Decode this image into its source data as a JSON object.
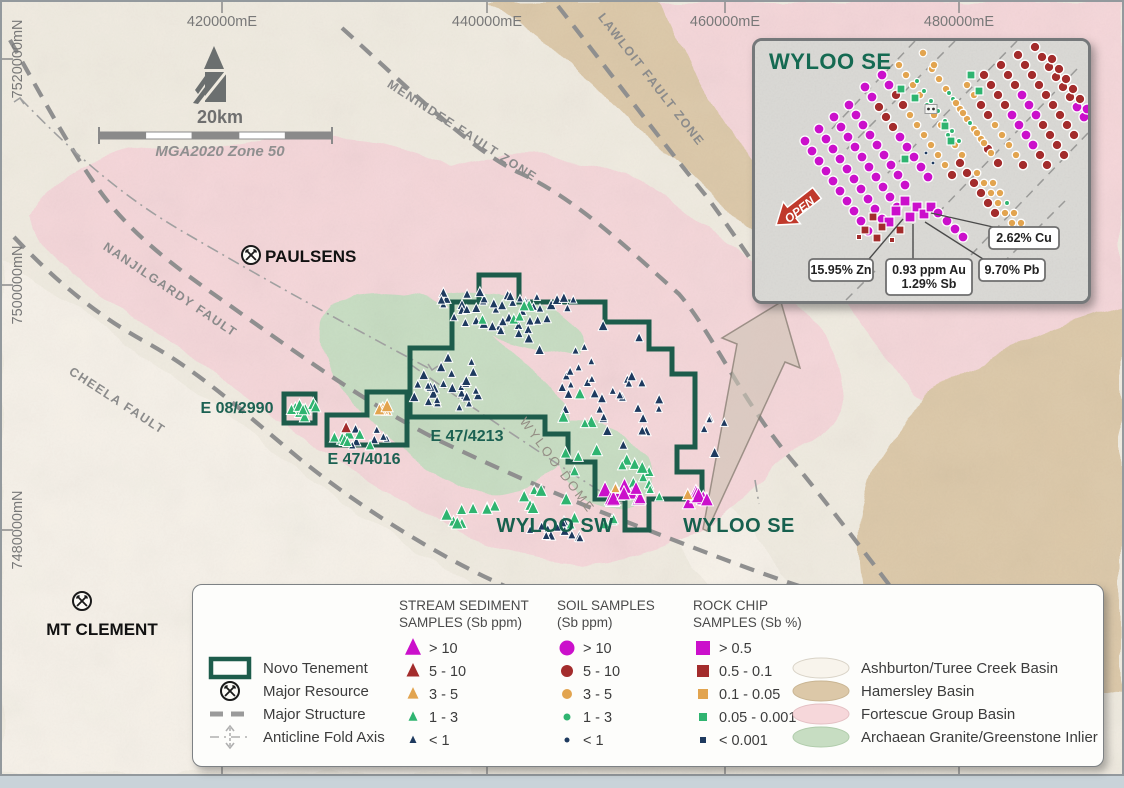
{
  "colors": {
    "magenta": "#cb10cb",
    "dark_red": "#a32c2c",
    "orange": "#e2a44f",
    "green": "#2fb470",
    "navy": "#1e3a5f",
    "tenement": "#1d5c4b",
    "label_green": "#156a52",
    "pink": "#f5d6d9",
    "tan": "#dcc8a8",
    "inlier_green": "#c7ddc2",
    "cream": "#f0ebe0",
    "offwhite": "#f7f3ea",
    "fault_gray": "#8f8f8f",
    "coord_gray": "#787878",
    "arrow_red": "#c0392b"
  },
  "map": {
    "eastings": [
      {
        "label": "420000mE",
        "x": 220
      },
      {
        "label": "440000mE",
        "x": 485
      },
      {
        "label": "460000mE",
        "x": 723
      },
      {
        "label": "480000mE",
        "x": 957
      }
    ],
    "northings": [
      {
        "label": "7520000mN",
        "y": 57
      },
      {
        "label": "7500000mN",
        "y": 283
      },
      {
        "label": "7480000mN",
        "y": 528
      }
    ],
    "scale": {
      "label": "20km",
      "datum": "MGA2020 Zone 50"
    },
    "places": [
      {
        "name": "PAULSENS",
        "sx": 249,
        "sy": 253,
        "tx": 263,
        "ty": 260,
        "anchor": "start"
      },
      {
        "name": "MT CLEMENT",
        "sx": 80,
        "sy": 599,
        "tx": 100,
        "ty": 633,
        "anchor": "middle"
      }
    ],
    "fault_labels": [
      {
        "name": "MENINDEE FAULT ZONE",
        "x": 458,
        "y": 132,
        "angle": 33
      },
      {
        "name": "LAWLOIT FAULT ZONE",
        "x": 646,
        "y": 80,
        "angle": 52
      },
      {
        "name": "NANJILGARDY FAULT",
        "x": 166,
        "y": 291,
        "angle": 34
      },
      {
        "name": "CHEELA FAULT",
        "x": 113,
        "y": 402,
        "angle": 33
      }
    ],
    "dome_label": {
      "name": "WYLOO DOME",
      "x": 552,
      "y": 466,
      "angle": 53
    },
    "area_labels": [
      {
        "name": "WYLOO SW",
        "x": 553,
        "y": 530
      },
      {
        "name": "WYLOO SE",
        "x": 737,
        "y": 530
      }
    ],
    "tenements": [
      {
        "name": "E 08/2990",
        "points": "282,392 313,392 313,421 282,421",
        "lx": 235,
        "ly": 411,
        "anchor": "middle"
      },
      {
        "name": "E 47/4016",
        "points": "325,413 365,413 365,390 405,390 405,443 325,443",
        "lx": 362,
        "ly": 462,
        "anchor": "middle"
      },
      {
        "name": "E 47/4213",
        "points": "408,346 450,346 450,300 477,300 477,273 517,273 517,300 603,300 603,320 647,320 647,347 670,347 670,372 693,372 693,445 675,445 675,470 700,470 700,497 647,497 647,528 623,528 623,497 593,497 593,460 566,460 566,432 543,432 543,415 408,415",
        "lx": 465,
        "ly": 439,
        "anchor": "middle"
      }
    ],
    "sample_clusters": [
      {
        "cx": 492,
        "cy": 312,
        "rx": 42,
        "ry": 20,
        "n": 24,
        "c": "navy",
        "s": 7
      },
      {
        "cx": 460,
        "cy": 296,
        "rx": 30,
        "ry": 10,
        "n": 8,
        "c": "navy",
        "s": 7
      },
      {
        "cx": 443,
        "cy": 380,
        "rx": 40,
        "ry": 28,
        "n": 28,
        "c": "navy",
        "s": 7
      },
      {
        "cx": 540,
        "cy": 330,
        "rx": 25,
        "ry": 20,
        "n": 6,
        "c": "navy",
        "s": 7
      },
      {
        "cx": 610,
        "cy": 390,
        "rx": 50,
        "ry": 70,
        "n": 34,
        "c": "navy",
        "s": 7
      },
      {
        "cx": 545,
        "cy": 300,
        "rx": 28,
        "ry": 10,
        "n": 8,
        "c": "navy",
        "s": 7
      },
      {
        "cx": 560,
        "cy": 528,
        "rx": 32,
        "ry": 10,
        "n": 12,
        "c": "navy",
        "s": 7
      },
      {
        "cx": 712,
        "cy": 432,
        "rx": 15,
        "ry": 22,
        "n": 5,
        "c": "navy",
        "s": 7
      },
      {
        "cx": 360,
        "cy": 436,
        "rx": 26,
        "ry": 10,
        "n": 7,
        "c": "navy",
        "s": 7
      },
      {
        "cx": 497,
        "cy": 308,
        "rx": 35,
        "ry": 12,
        "n": 6,
        "c": "green",
        "s": 9
      },
      {
        "cx": 578,
        "cy": 420,
        "rx": 22,
        "ry": 55,
        "n": 8,
        "c": "green",
        "s": 9
      },
      {
        "cx": 470,
        "cy": 512,
        "rx": 30,
        "ry": 12,
        "n": 9,
        "c": "green",
        "s": 9
      },
      {
        "cx": 540,
        "cy": 500,
        "rx": 25,
        "ry": 12,
        "n": 6,
        "c": "green",
        "s": 9
      },
      {
        "cx": 620,
        "cy": 472,
        "rx": 28,
        "ry": 14,
        "n": 7,
        "c": "green",
        "s": 9
      },
      {
        "cx": 302,
        "cy": 407,
        "rx": 13,
        "ry": 9,
        "n": 9,
        "c": "green",
        "s": 9
      },
      {
        "cx": 352,
        "cy": 438,
        "rx": 24,
        "ry": 10,
        "n": 7,
        "c": "green",
        "s": 9
      },
      {
        "cx": 648,
        "cy": 490,
        "rx": 20,
        "ry": 8,
        "n": 5,
        "c": "green",
        "s": 8
      },
      {
        "cx": 590,
        "cy": 520,
        "rx": 25,
        "ry": 8,
        "n": 5,
        "c": "green",
        "s": 8
      },
      {
        "cx": 383,
        "cy": 402,
        "rx": 13,
        "ry": 8,
        "n": 5,
        "c": "orange",
        "s": 10
      },
      {
        "cx": 344,
        "cy": 428,
        "rx": 3,
        "ry": 3,
        "n": 1,
        "c": "dark_red",
        "s": 10
      },
      {
        "cx": 622,
        "cy": 492,
        "rx": 22,
        "ry": 9,
        "n": 11,
        "c": "magenta",
        "s": 12
      },
      {
        "cx": 696,
        "cy": 499,
        "rx": 13,
        "ry": 8,
        "n": 8,
        "c": "magenta",
        "s": 12
      },
      {
        "cx": 617,
        "cy": 487,
        "rx": 4,
        "ry": 3,
        "n": 2,
        "c": "orange",
        "s": 9
      },
      {
        "cx": 686,
        "cy": 492,
        "rx": 3,
        "ry": 3,
        "n": 1,
        "c": "orange",
        "s": 9
      }
    ]
  },
  "inset": {
    "title": "WYLOO SE",
    "open_label": "OPEN",
    "callouts": [
      {
        "lines": [
          "15.95% Zn"
        ],
        "x": 54,
        "y": 218,
        "w": 64,
        "h": 22,
        "tx": 148,
        "ty": 178
      },
      {
        "lines": [
          "0.93 ppm Au",
          "1.29% Sb"
        ],
        "x": 131,
        "y": 218,
        "w": 86,
        "h": 36,
        "tx": 158,
        "ty": 183
      },
      {
        "lines": [
          "9.70% Pb"
        ],
        "x": 224,
        "y": 218,
        "w": 66,
        "h": 22,
        "tx": 170,
        "ty": 181
      },
      {
        "lines": [
          "2.62% Cu"
        ],
        "x": 234,
        "y": 186,
        "w": 70,
        "h": 22,
        "tx": 176,
        "ty": 172
      }
    ],
    "chains": [
      {
        "x": 50,
        "y": 100,
        "n": 10,
        "colors": "M"
      },
      {
        "x": 64,
        "y": 88,
        "n": 10,
        "colors": "M"
      },
      {
        "x": 79,
        "y": 76,
        "n": 10,
        "colors": "M"
      },
      {
        "x": 94,
        "y": 64,
        "n": 9,
        "colors": "M"
      },
      {
        "x": 110,
        "y": 46,
        "n": 10,
        "colors": [
          "M",
          "M",
          "R",
          "R",
          "R",
          "M",
          "M",
          "M",
          "M",
          "M"
        ]
      },
      {
        "x": 127,
        "y": 34,
        "n": 11,
        "colors": [
          "M",
          "M",
          "R",
          "R",
          "O",
          "O",
          "O",
          "O",
          "O",
          "O",
          "R"
        ]
      },
      {
        "x": 144,
        "y": 24,
        "n": 10,
        "colors": [
          "O",
          "O",
          "O",
          "O",
          "G",
          "O",
          "O",
          "G",
          "O",
          "O"
        ]
      },
      {
        "x": 162,
        "y": 40,
        "n": 7,
        "colors": "G"
      },
      {
        "x": 177,
        "y": 28,
        "n": 9,
        "colors": [
          "O",
          "O",
          "O",
          "G",
          "O",
          "O",
          "O",
          "O",
          "R"
        ]
      },
      {
        "x": 194,
        "y": 52,
        "n": 8,
        "colors": [
          "G",
          "O",
          "O",
          "G",
          "O",
          "O",
          "O",
          "R"
        ]
      },
      {
        "x": 212,
        "y": 44,
        "n": 9,
        "colors": [
          "O",
          "O",
          "R",
          "R",
          "O",
          "O",
          "O",
          "O",
          "R"
        ]
      },
      {
        "x": 229,
        "y": 34,
        "n": 10,
        "colors": [
          "R",
          "R",
          "R",
          "R",
          "M",
          "M",
          "M",
          "M",
          "R",
          "R"
        ]
      },
      {
        "x": 246,
        "y": 24,
        "n": 10,
        "colors": [
          "R",
          "R",
          "R",
          "M",
          "M",
          "M",
          "R",
          "R",
          "R",
          "R"
        ]
      },
      {
        "x": 263,
        "y": 14,
        "n": 9,
        "colors": "R"
      },
      {
        "x": 280,
        "y": 6,
        "n": 8,
        "colors": [
          "R",
          "R",
          "R",
          "R",
          "R",
          "R",
          "M",
          "M"
        ]
      },
      {
        "x": 297,
        "y": 18,
        "n": 9,
        "colors": [
          "R",
          "R",
          "R",
          "R",
          "R",
          "M",
          "M",
          "M",
          "M"
        ]
      },
      {
        "x": 205,
        "y": 122,
        "n": 6,
        "colors": "R"
      },
      {
        "x": 222,
        "y": 132,
        "n": 6,
        "colors": "O"
      },
      {
        "x": 238,
        "y": 142,
        "n": 5,
        "colors": [
          "O",
          "O",
          "G",
          "O",
          "O"
        ]
      }
    ],
    "extra_orange": [
      [
        168,
        12
      ],
      [
        179,
        24
      ]
    ],
    "green_squares": [
      [
        146,
        48
      ],
      [
        160,
        57
      ],
      [
        216,
        34
      ],
      [
        224,
        50
      ],
      [
        190,
        85
      ],
      [
        150,
        118
      ],
      [
        196,
        100
      ]
    ],
    "white_squares": [
      [
        176,
        68
      ]
    ],
    "navy_dots": [
      [
        171,
        112
      ],
      [
        178,
        122
      ]
    ],
    "rock_chips": {
      "magenta_sq": [
        [
          150,
          160
        ],
        [
          162,
          166
        ],
        [
          141,
          170
        ],
        [
          155,
          176
        ],
        [
          169,
          173
        ],
        [
          134,
          181
        ],
        [
          176,
          166
        ]
      ],
      "red_sq": [
        [
          118,
          176
        ],
        [
          127,
          186
        ],
        [
          110,
          189
        ],
        [
          145,
          189
        ],
        [
          122,
          197
        ]
      ],
      "small_red_sq": [
        [
          104,
          196
        ],
        [
          137,
          199
        ]
      ],
      "magenta_circ": [
        [
          183,
          172
        ],
        [
          192,
          180
        ],
        [
          200,
          188
        ],
        [
          208,
          196
        ]
      ]
    }
  },
  "legend": {
    "map_items": [
      {
        "label": "Novo Tenement",
        "symbol": "tenement"
      },
      {
        "label": "Major Resource",
        "symbol": "resource"
      },
      {
        "label": "Major Structure",
        "symbol": "structure"
      },
      {
        "label": "Anticline Fold Axis",
        "symbol": "anticline"
      }
    ],
    "sample_columns": [
      {
        "title": [
          "STREAM SEDIMENT",
          "SAMPLES (Sb ppm)"
        ],
        "shape": "triangle",
        "hx": 206,
        "sx": 220,
        "lx": 236,
        "items": [
          {
            "label": "> 10",
            "color": "magenta",
            "size": 16
          },
          {
            "label": "5 - 10",
            "color": "dark_red",
            "size": 13
          },
          {
            "label": "3 - 5",
            "color": "orange",
            "size": 11
          },
          {
            "label": "1 - 3",
            "color": "green",
            "size": 9
          },
          {
            "label": "< 1",
            "color": "navy",
            "size": 7
          }
        ]
      },
      {
        "title": [
          "SOIL SAMPLES",
          "(Sb ppm)"
        ],
        "shape": "circle",
        "hx": 364,
        "sx": 374,
        "lx": 390,
        "items": [
          {
            "label": "> 10",
            "color": "magenta",
            "size": 15
          },
          {
            "label": "5 - 10",
            "color": "dark_red",
            "size": 12
          },
          {
            "label": "3 - 5",
            "color": "orange",
            "size": 10
          },
          {
            "label": "1 - 3",
            "color": "green",
            "size": 7
          },
          {
            "label": "< 1",
            "color": "navy",
            "size": 5
          }
        ]
      },
      {
        "title": [
          "ROCK CHIP",
          "SAMPLES (Sb %)"
        ],
        "shape": "square",
        "hx": 500,
        "sx": 510,
        "lx": 526,
        "items": [
          {
            "label": "> 0.5",
            "color": "magenta",
            "size": 14
          },
          {
            "label": "0.5 - 0.1",
            "color": "dark_red",
            "size": 12
          },
          {
            "label": "0.1 - 0.05",
            "color": "orange",
            "size": 10
          },
          {
            "label": "0.05 - 0.001",
            "color": "green",
            "size": 8
          },
          {
            "label": "< 0.001",
            "color": "navy",
            "size": 6
          }
        ]
      }
    ],
    "geology_items": [
      {
        "label": "Ashburton/Turee Creek Basin",
        "color": "#f8f4ec",
        "stroke": "#d9d3c7"
      },
      {
        "label": "Hamersley Basin",
        "color": "#dcc8a8",
        "stroke": "#c9b593"
      },
      {
        "label": "Fortescue Group Basin",
        "color": "#f6d7da",
        "stroke": "#e4c0c4"
      },
      {
        "label": "Archaean Granite/Greenstone Inlier",
        "color": "#c7ddc2",
        "stroke": "#b0ccab"
      }
    ]
  }
}
